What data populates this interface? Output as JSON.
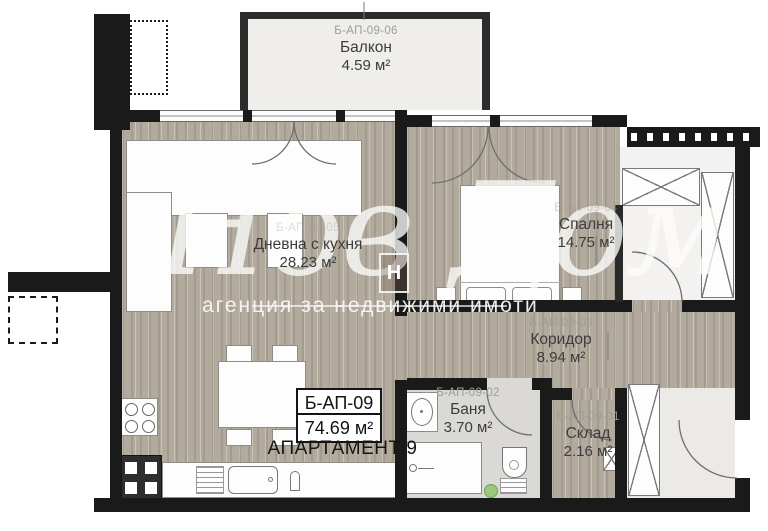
{
  "watermark": {
    "brand_script": "Нов Дом",
    "tagline": "агенция за недвижими имоти",
    "logo_letter": "Н"
  },
  "apartment": {
    "code": "Б-АП-09",
    "total_area": "74.69 м²",
    "title": "АПАРТАМЕНТ 9"
  },
  "rooms": {
    "balcony": {
      "code": "Б-АП-09-06",
      "name": "Балкон",
      "area": "4.59 м²"
    },
    "living": {
      "code": "Б-АП-09-05",
      "name": "Дневна с кухня",
      "area": "28.23 м²"
    },
    "bedroom": {
      "code": "Б-АП-09-04",
      "name": "Спалня",
      "area": "14.75 м²"
    },
    "corridor": {
      "code": "Б-АП-09-03",
      "name": "Коридор",
      "area": "8.94 м²"
    },
    "bathroom": {
      "code": "Б-АП-09-02",
      "name": "Баня",
      "area": "3.70 м²"
    },
    "storage": {
      "code": "Б-АП-09-01",
      "name": "Склад",
      "area": "2.16 м²"
    }
  },
  "colors": {
    "wall": "#1a1a1a",
    "wood_floor": "#b3aa9e",
    "balcony_floor": "#efeeea",
    "bath_floor": "#dbd9d5",
    "accent_green": "#9cc87e"
  }
}
